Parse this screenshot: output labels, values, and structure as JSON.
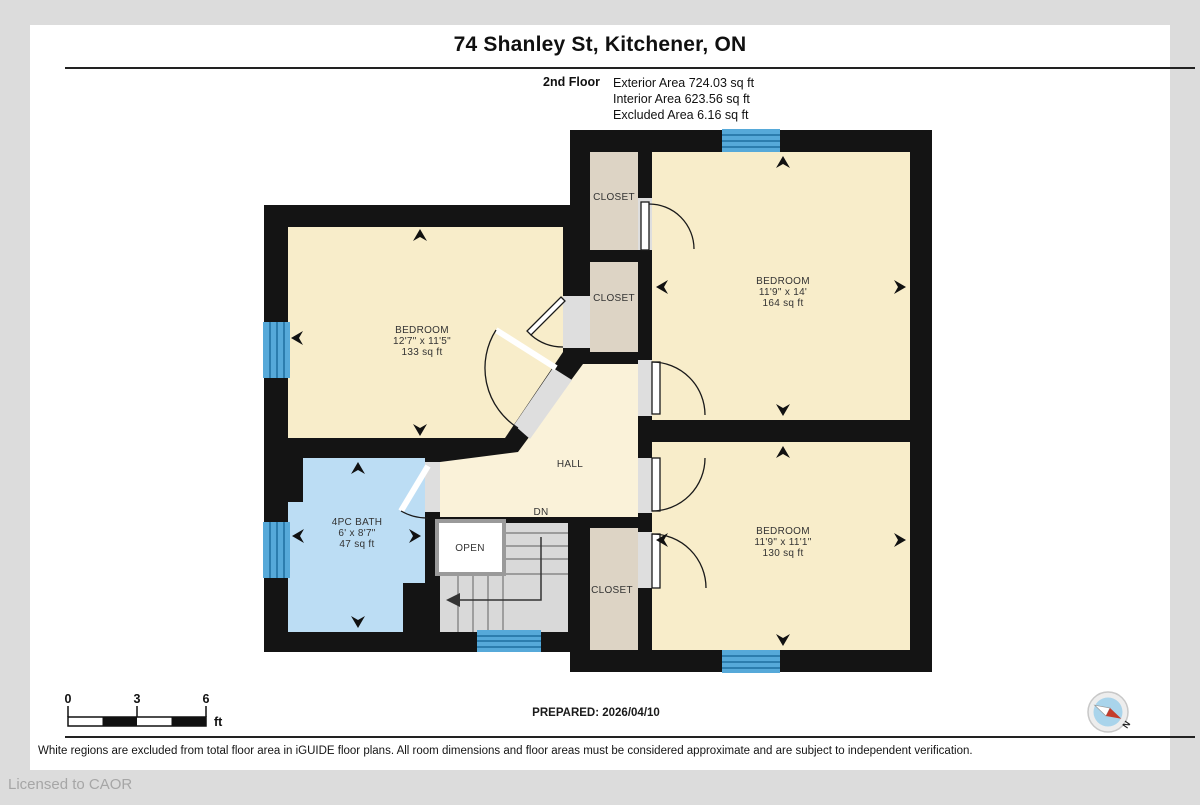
{
  "page": {
    "title": "74 Shanley St, Kitchener, ON",
    "floor": {
      "name": "2nd Floor",
      "areas": [
        "Exterior Area 724.03 sq ft",
        "Interior Area 623.56 sq ft",
        "Excluded Area 6.16 sq ft"
      ]
    }
  },
  "plan": {
    "rooms": {
      "bedroom_left": {
        "name": "BEDROOM",
        "dims": "12'7\" x 11'5\"",
        "area": "133 sq ft"
      },
      "bedroom_top_right": {
        "name": "BEDROOM",
        "dims": "11'9\" x 14'",
        "area": "164 sq ft"
      },
      "bedroom_bottom_right": {
        "name": "BEDROOM",
        "dims": "11'9\" x 11'1\"",
        "area": "130 sq ft"
      },
      "bath": {
        "name": "4PC BATH",
        "dims": "6' x 8'7\"",
        "area": "47 sq ft"
      },
      "hall": {
        "name": "HALL"
      },
      "closets": {
        "top": "CLOSET",
        "middle": "CLOSET",
        "bottom": "CLOSET"
      },
      "stairs": {
        "open_label": "OPEN",
        "down_label": "DN"
      }
    },
    "colors": {
      "wall": "#141414",
      "bedroom": "#f8edca",
      "closet": "#ddd4c5",
      "bath": "#bcddf4",
      "hall": "#faf2d9",
      "stairs": "#d9d9d9",
      "window": "#56a9d9",
      "window_line": "#1f6f9f",
      "door_gap": "#dedede",
      "canvas": "#dcdcdc",
      "compass_face": "#a9d4eb",
      "compass_red": "#c43c2b"
    }
  },
  "footer": {
    "scale": {
      "ticks": [
        "0",
        "3",
        "6"
      ],
      "unit": "ft"
    },
    "prepared": "PREPARED: 2026/04/10",
    "compass_north": "N",
    "disclaimer": "White regions are excluded from total floor area in iGUIDE floor plans. All room dimensions and floor areas must be considered approximate and are subject to independent verification."
  },
  "watermark": "Licensed to CAOR"
}
